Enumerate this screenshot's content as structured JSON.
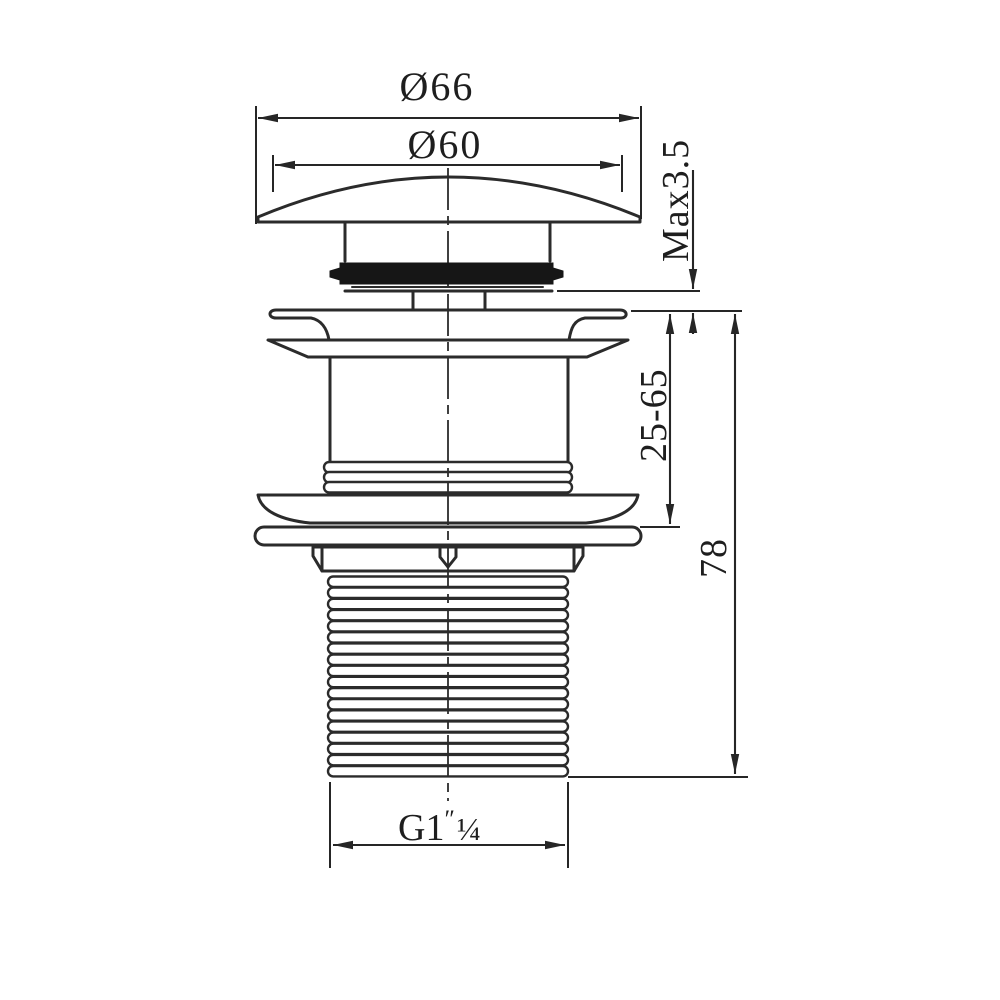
{
  "drawing": {
    "colors": {
      "background": "#ffffff",
      "line": "#2b2b2b",
      "gasket_fill": "#161616",
      "text": "#1e1e1e"
    },
    "dimensions": {
      "cap_outer_diameter": "Ø66",
      "cap_top_diameter": "Ø60",
      "max_gap": "Max3.5",
      "clamping_range": "25-65",
      "body_length": "78",
      "thread_size_main": "G1",
      "thread_size_prime": "″",
      "thread_size_fraction": "¼"
    }
  }
}
